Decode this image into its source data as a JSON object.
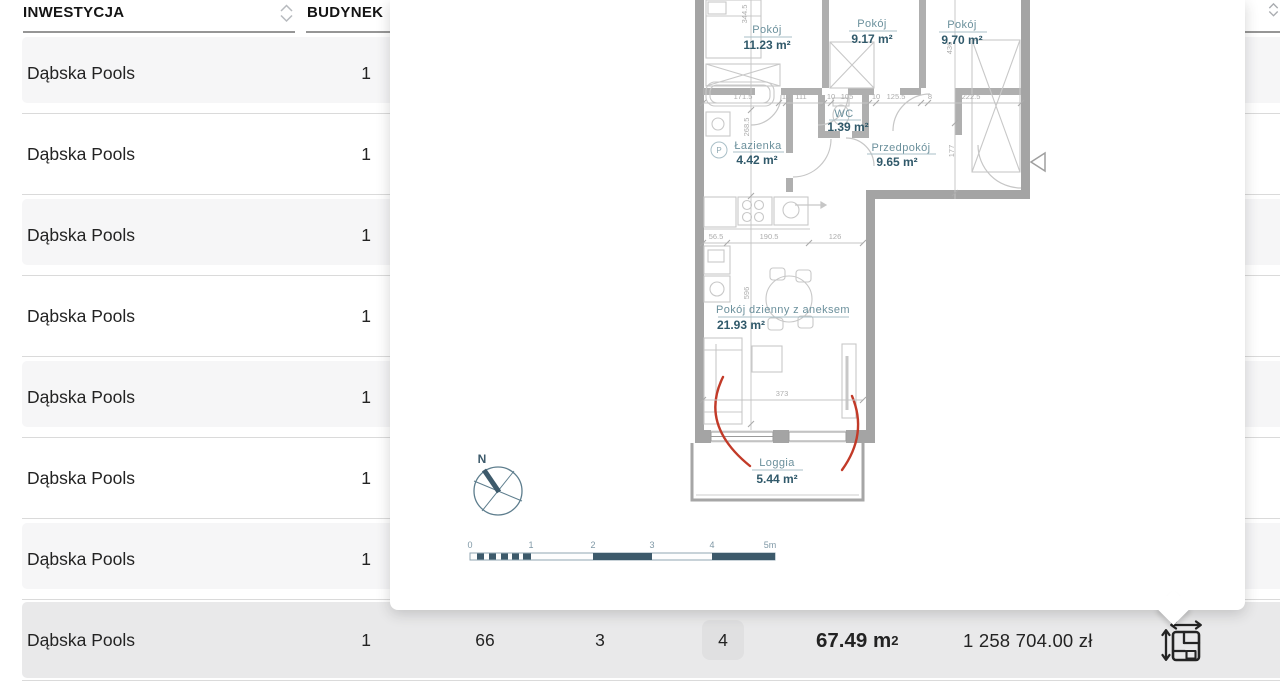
{
  "colors": {
    "stripe_row": "#f6f6f7",
    "selected_row": "#e9e9ea",
    "separator": "#dadada",
    "header_underline": "#969696",
    "plan_wall": "#a4a4a4",
    "plan_label": "#6b909c",
    "plan_area": "#30596a",
    "plan_dim": "#adadad",
    "plan_red_arc": "#c23a28",
    "compass_scale": "#3d5a6b"
  },
  "icons": {
    "header_sort": "sort-unfold-icon",
    "row_plan": "floorplan-dimensions-icon",
    "entrance": "entrance-triangle-marker"
  },
  "table": {
    "header": {
      "inwestycja": "INWESTYCJA",
      "budynek": "BUDYNEK"
    },
    "rows": [
      {
        "inwestycja": "Dąbska Pools",
        "budynek": "1"
      },
      {
        "inwestycja": "Dąbska Pools",
        "budynek": "1"
      },
      {
        "inwestycja": "Dąbska Pools",
        "budynek": "1"
      },
      {
        "inwestycja": "Dąbska Pools",
        "budynek": "1"
      },
      {
        "inwestycja": "Dąbska Pools",
        "budynek": "1"
      },
      {
        "inwestycja": "Dąbska Pools",
        "budynek": "1"
      },
      {
        "inwestycja": "Dąbska Pools",
        "budynek": "1"
      }
    ],
    "selected_row": {
      "inwestycja": "Dąbska Pools",
      "budynek": "1",
      "col3": "66",
      "col4": "3",
      "badge": "4",
      "area_value": "67.49 m",
      "area_sup": "2",
      "price": "1 258 704.00 zł"
    }
  },
  "floorplan": {
    "rooms": [
      {
        "name": "Pokój",
        "area": "11.23 m²"
      },
      {
        "name": "Pokój",
        "area": "9.17 m²"
      },
      {
        "name": "Pokój",
        "area": "9.70 m²"
      },
      {
        "name": "WC",
        "area": "1.39 m²"
      },
      {
        "name": "Łazienka",
        "area": "4.42 m²"
      },
      {
        "name": "Przedpokój",
        "area": "9.65 m²"
      },
      {
        "name": "Pokój dzienny z aneksem",
        "area": "21.93 m²"
      },
      {
        "name": "Loggia",
        "area": "5.44 m²"
      }
    ],
    "appliance_badge": "P",
    "dims": {
      "d1": "171.5",
      "d2": "10",
      "d3": "111",
      "d4": "10",
      "d5": "105",
      "d6": "10",
      "d7": "125.5",
      "d8": "8",
      "d9": "222.5",
      "d10": "56.5",
      "d11": "190.5",
      "d12": "126",
      "d13": "373",
      "v1": "344.5",
      "v2": "268.5",
      "v3": "596",
      "v4": "436",
      "v5": "177"
    },
    "compass_n": "N",
    "scale_labels": [
      "0",
      "1",
      "2",
      "3",
      "4",
      "5m"
    ]
  }
}
